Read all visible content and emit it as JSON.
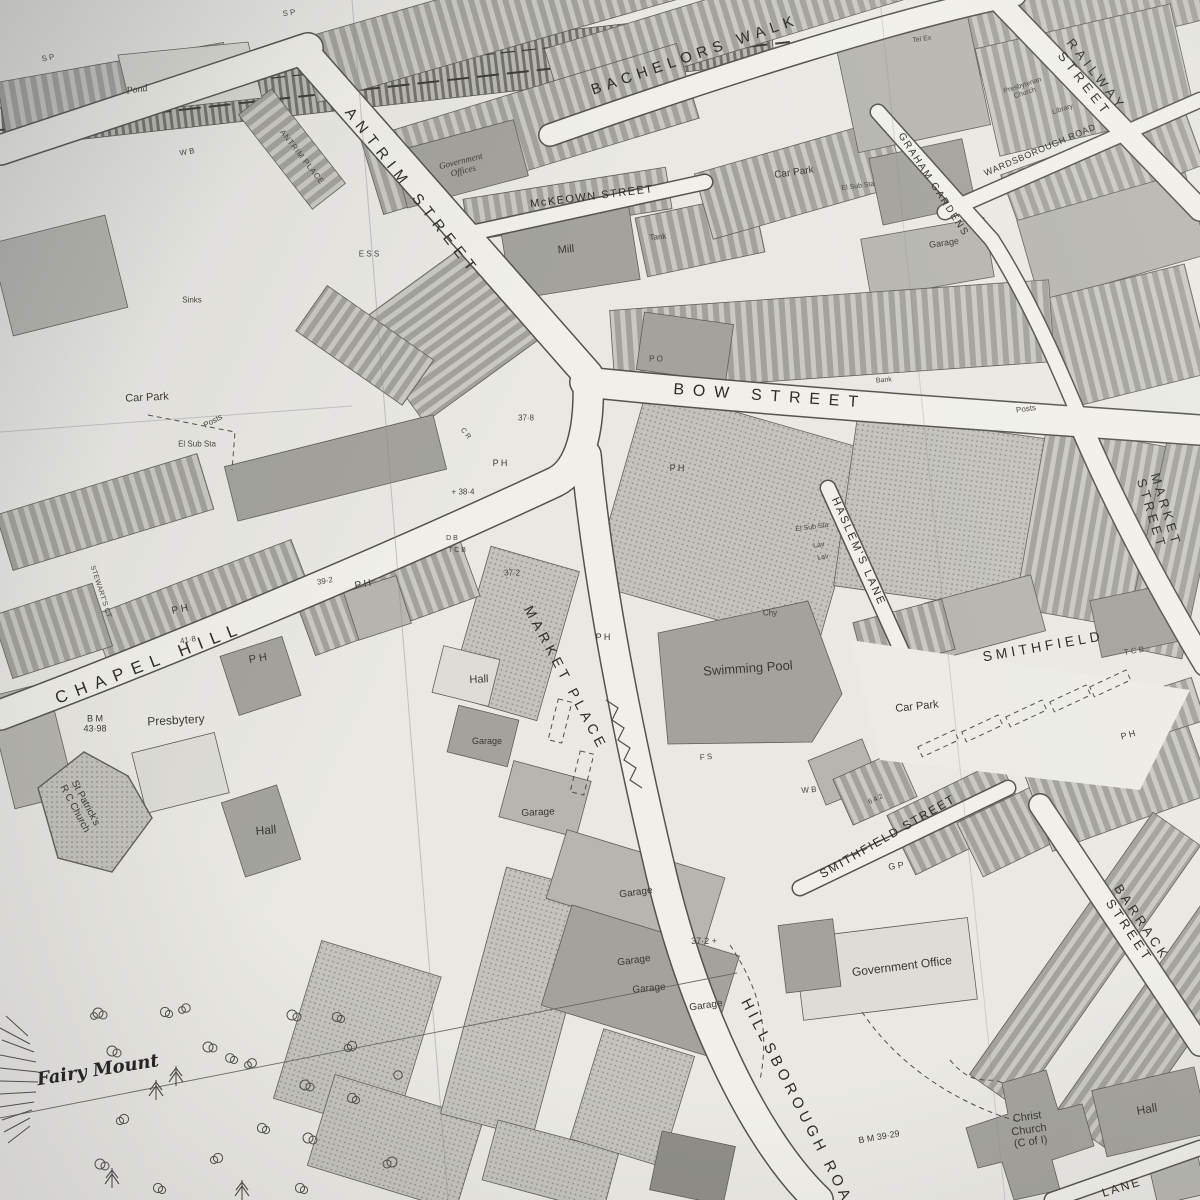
{
  "meta": {
    "description": "Black-and-white Ordnance Survey style town plan (photographed paper map) showing streets around Bow Street, Market Place and Smithfield",
    "colors": {
      "paper": "#e9e8e3",
      "ink": "#33322e",
      "building_grey": "#a9a8a2",
      "light_block": "#c7c6c0"
    }
  },
  "labels": [
    {
      "text": "ANTRIM STREET",
      "x": 412,
      "y": 192,
      "rot": 52,
      "fs": 15,
      "ls": "0.45em",
      "cls": "street"
    },
    {
      "text": "BACHELORS WALK",
      "x": 695,
      "y": 55,
      "rot": -19,
      "fs": 15,
      "ls": "0.38em",
      "cls": "street"
    },
    {
      "text": "McKEOWN STREET",
      "x": 592,
      "y": 197,
      "rot": -7,
      "fs": 11,
      "ls": "0.14em",
      "cls": "street"
    },
    {
      "text": "BOW STREET",
      "x": 770,
      "y": 397,
      "rot": 4,
      "fs": 16,
      "ls": "0.55em",
      "cls": "street"
    },
    {
      "text": "RAILWAY STREET",
      "x": 1090,
      "y": 80,
      "rot": 52,
      "fs": 13,
      "ls": "0.35em",
      "cls": "street"
    },
    {
      "text": "GRAHAM GARDENS",
      "x": 933,
      "y": 185,
      "rot": 57,
      "fs": 10,
      "ls": "0.18em",
      "cls": "street"
    },
    {
      "text": "WARDSBOROUGH ROAD",
      "x": 1040,
      "y": 150,
      "rot": -23,
      "fs": 9,
      "ls": "0.08em",
      "cls": "street"
    },
    {
      "text": "MARKET STREET",
      "x": 1158,
      "y": 512,
      "rot": 73,
      "fs": 13,
      "ls": "0.28em",
      "cls": "street"
    },
    {
      "text": "HASLEM'S LANE",
      "x": 858,
      "y": 552,
      "rot": 66,
      "fs": 11,
      "ls": "0.22em",
      "cls": "street"
    },
    {
      "text": "CHAPEL HILL",
      "x": 150,
      "y": 663,
      "rot": -21,
      "fs": 17,
      "ls": "0.5em",
      "cls": "street"
    },
    {
      "text": "MARKET PLACE",
      "x": 566,
      "y": 678,
      "rot": 62,
      "fs": 14,
      "ls": "0.32em",
      "cls": "street"
    },
    {
      "text": "SMITHFIELD",
      "x": 1043,
      "y": 646,
      "rot": -10,
      "fs": 14,
      "ls": "0.28em",
      "cls": "street"
    },
    {
      "text": "SMITHFIELD STREET",
      "x": 888,
      "y": 837,
      "rot": -30,
      "fs": 12,
      "ls": "0.16em",
      "cls": "street"
    },
    {
      "text": "BARRACK STREET",
      "x": 1135,
      "y": 927,
      "rot": 56,
      "fs": 13,
      "ls": "0.28em",
      "cls": "street"
    },
    {
      "text": "HILLSBOROUGH ROAD",
      "x": 800,
      "y": 1108,
      "rot": 63,
      "fs": 15,
      "ls": "0.3em",
      "cls": "street"
    },
    {
      "text": "LANE",
      "x": 1122,
      "y": 1188,
      "rot": -17,
      "fs": 12,
      "ls": "0.2em",
      "cls": "street"
    },
    {
      "text": "ANTRIM PLACE",
      "x": 302,
      "y": 157,
      "rot": 52,
      "fs": 8,
      "ls": "0.08em",
      "cls": "street tiny"
    },
    {
      "text": "STEWART'S CT",
      "x": 100,
      "y": 592,
      "rot": 72,
      "fs": 7,
      "ls": "0.04em",
      "cls": "street tiny"
    },
    {
      "text": "Pond",
      "x": 137,
      "y": 90,
      "rot": -8,
      "fs": 10,
      "cls": "place italic"
    },
    {
      "text": "S P",
      "x": 48,
      "y": 58,
      "rot": -10,
      "fs": 8,
      "cls": "tiny"
    },
    {
      "text": "S P",
      "x": 289,
      "y": 13,
      "rot": -8,
      "fs": 8,
      "cls": "tiny"
    },
    {
      "text": "W B",
      "x": 187,
      "y": 152,
      "rot": -10,
      "fs": 8,
      "cls": "tiny"
    },
    {
      "text": "Government\nOffices",
      "x": 462,
      "y": 166,
      "rot": -14,
      "fs": 9,
      "cls": "place italic"
    },
    {
      "text": "Mill",
      "x": 566,
      "y": 250,
      "rot": -5,
      "fs": 11,
      "cls": "place"
    },
    {
      "text": "Tank",
      "x": 658,
      "y": 237,
      "rot": -5,
      "fs": 8,
      "cls": "tiny"
    },
    {
      "text": "E S S",
      "x": 369,
      "y": 254,
      "rot": 0,
      "fs": 8,
      "cls": "tiny"
    },
    {
      "text": "Sinks",
      "x": 192,
      "y": 300,
      "rot": 0,
      "fs": 8,
      "cls": "tiny"
    },
    {
      "text": "Car Park",
      "x": 147,
      "y": 398,
      "rot": -3,
      "fs": 11,
      "cls": "place"
    },
    {
      "text": "Posts",
      "x": 213,
      "y": 421,
      "rot": -28,
      "fs": 8,
      "cls": "tiny"
    },
    {
      "text": "El Sub Sta",
      "x": 197,
      "y": 444,
      "rot": 0,
      "fs": 8,
      "cls": "tiny"
    },
    {
      "text": "Car Park",
      "x": 794,
      "y": 173,
      "rot": -8,
      "fs": 10,
      "cls": "place"
    },
    {
      "text": "El Sub Sta",
      "x": 858,
      "y": 187,
      "rot": -8,
      "fs": 7,
      "cls": "tiny"
    },
    {
      "text": "Garage",
      "x": 944,
      "y": 243,
      "rot": -8,
      "fs": 9,
      "cls": "place"
    },
    {
      "text": "Tel Ex",
      "x": 922,
      "y": 40,
      "rot": -8,
      "fs": 7,
      "cls": "tiny"
    },
    {
      "text": "Presbyterian\nChurch",
      "x": 1024,
      "y": 90,
      "rot": -18,
      "fs": 7,
      "cls": "tiny"
    },
    {
      "text": "Library",
      "x": 1063,
      "y": 110,
      "rot": -18,
      "fs": 7,
      "cls": "tiny"
    },
    {
      "text": "P O",
      "x": 656,
      "y": 359,
      "rot": 0,
      "fs": 8,
      "cls": "tiny"
    },
    {
      "text": "Bank",
      "x": 884,
      "y": 381,
      "rot": -5,
      "fs": 7,
      "cls": "tiny"
    },
    {
      "text": "Posts",
      "x": 1026,
      "y": 409,
      "rot": -8,
      "fs": 8,
      "cls": "tiny"
    },
    {
      "text": "37·8",
      "x": 526,
      "y": 418,
      "rot": 0,
      "fs": 8,
      "cls": "tiny"
    },
    {
      "text": "+ 38·4",
      "x": 463,
      "y": 492,
      "rot": 0,
      "fs": 8,
      "cls": "tiny"
    },
    {
      "text": "C R",
      "x": 465,
      "y": 434,
      "rot": 52,
      "fs": 7,
      "cls": "tiny"
    },
    {
      "text": "D B",
      "x": 452,
      "y": 539,
      "rot": 0,
      "fs": 7,
      "cls": "tiny"
    },
    {
      "text": "T C B",
      "x": 457,
      "y": 551,
      "rot": 0,
      "fs": 7,
      "cls": "tiny"
    },
    {
      "text": "P H",
      "x": 500,
      "y": 463,
      "rot": 0,
      "fs": 9,
      "cls": "place"
    },
    {
      "text": "P H",
      "x": 677,
      "y": 468,
      "rot": 0,
      "fs": 9,
      "cls": "place"
    },
    {
      "text": "P H",
      "x": 363,
      "y": 585,
      "rot": -10,
      "fs": 10,
      "cls": "place"
    },
    {
      "text": "P H",
      "x": 180,
      "y": 610,
      "rot": -12,
      "fs": 10,
      "cls": "place"
    },
    {
      "text": "P H",
      "x": 258,
      "y": 659,
      "rot": -10,
      "fs": 11,
      "cls": "place"
    },
    {
      "text": "P H",
      "x": 603,
      "y": 637,
      "rot": 0,
      "fs": 9,
      "cls": "place"
    },
    {
      "text": "P H",
      "x": 1128,
      "y": 735,
      "rot": -15,
      "fs": 9,
      "cls": "place"
    },
    {
      "text": "39·2",
      "x": 325,
      "y": 581,
      "rot": -10,
      "fs": 8,
      "cls": "tiny"
    },
    {
      "text": "41·8",
      "x": 188,
      "y": 640,
      "rot": -10,
      "fs": 8,
      "cls": "tiny"
    },
    {
      "text": "B M\n43·98",
      "x": 95,
      "y": 724,
      "rot": 0,
      "fs": 9,
      "cls": "place"
    },
    {
      "text": "Presbytery",
      "x": 176,
      "y": 721,
      "rot": -3,
      "fs": 12,
      "cls": "place"
    },
    {
      "text": "St Patrick's\nR C Church",
      "x": 80,
      "y": 806,
      "rot": 62,
      "fs": 10,
      "cls": "place"
    },
    {
      "text": "Hall",
      "x": 266,
      "y": 831,
      "rot": -5,
      "fs": 12,
      "cls": "place"
    },
    {
      "text": "Hall",
      "x": 479,
      "y": 680,
      "rot": -3,
      "fs": 11,
      "cls": "place"
    },
    {
      "text": "Garage",
      "x": 487,
      "y": 741,
      "rot": 0,
      "fs": 9,
      "cls": "place"
    },
    {
      "text": "Garage",
      "x": 538,
      "y": 813,
      "rot": -3,
      "fs": 10,
      "cls": "place"
    },
    {
      "text": "Garage",
      "x": 636,
      "y": 893,
      "rot": -8,
      "fs": 10,
      "cls": "place"
    },
    {
      "text": "Garage",
      "x": 634,
      "y": 961,
      "rot": -8,
      "fs": 10,
      "cls": "place"
    },
    {
      "text": "Garage",
      "x": 649,
      "y": 989,
      "rot": -5,
      "fs": 10,
      "cls": "place"
    },
    {
      "text": "Garage",
      "x": 706,
      "y": 1006,
      "rot": -8,
      "fs": 10,
      "cls": "place"
    },
    {
      "text": "37·2",
      "x": 512,
      "y": 573,
      "rot": 0,
      "fs": 8,
      "cls": "tiny"
    },
    {
      "text": "37·2 +",
      "x": 704,
      "y": 941,
      "rot": 0,
      "fs": 9,
      "cls": "tiny"
    },
    {
      "text": "Chy",
      "x": 770,
      "y": 613,
      "rot": 0,
      "fs": 8,
      "cls": "tiny"
    },
    {
      "text": "F S",
      "x": 706,
      "y": 757,
      "rot": -5,
      "fs": 8,
      "cls": "tiny"
    },
    {
      "text": "Swimming Pool",
      "x": 748,
      "y": 669,
      "rot": -4,
      "fs": 13,
      "cls": "place"
    },
    {
      "text": "El Sub Sta",
      "x": 812,
      "y": 528,
      "rot": -8,
      "fs": 7,
      "cls": "tiny"
    },
    {
      "text": "Lav",
      "x": 819,
      "y": 546,
      "rot": -8,
      "fs": 7,
      "cls": "tiny"
    },
    {
      "text": "Lav",
      "x": 823,
      "y": 558,
      "rot": -8,
      "fs": 7,
      "cls": "tiny"
    },
    {
      "text": "W B",
      "x": 809,
      "y": 790,
      "rot": -5,
      "fs": 8,
      "cls": "tiny"
    },
    {
      "text": "G P",
      "x": 896,
      "y": 866,
      "rot": -8,
      "fs": 9,
      "cls": "tiny"
    },
    {
      "text": "6 4 2",
      "x": 876,
      "y": 800,
      "rot": -25,
      "fs": 7,
      "cls": "tiny"
    },
    {
      "text": "Government Office",
      "x": 902,
      "y": 967,
      "rot": -7,
      "fs": 12,
      "cls": "place"
    },
    {
      "text": "Car Park",
      "x": 917,
      "y": 707,
      "rot": -6,
      "fs": 11,
      "cls": "place"
    },
    {
      "text": "T C B",
      "x": 1134,
      "y": 651,
      "rot": -10,
      "fs": 8,
      "cls": "tiny"
    },
    {
      "text": "Hall",
      "x": 1147,
      "y": 1110,
      "rot": -10,
      "fs": 12,
      "cls": "place"
    },
    {
      "text": "Christ\nChurch\n(C of I)",
      "x": 1029,
      "y": 1130,
      "rot": -8,
      "fs": 11,
      "cls": "place"
    },
    {
      "text": "B M 39·29",
      "x": 879,
      "y": 1137,
      "rot": -10,
      "fs": 9,
      "cls": "place"
    },
    {
      "text": "Fairy Mount",
      "x": 98,
      "y": 1071,
      "rot": -9,
      "fs": 18,
      "cls": "gothic"
    }
  ]
}
